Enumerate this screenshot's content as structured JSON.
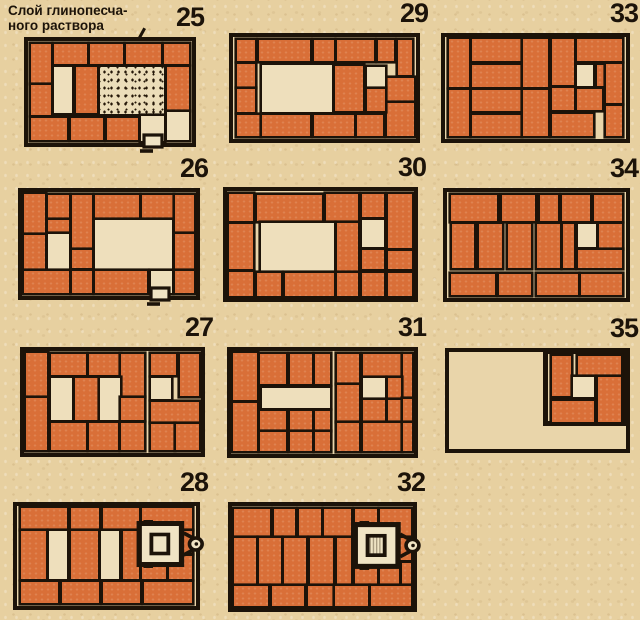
{
  "figure": {
    "annotation_line1": "Слой глинопесча-",
    "annotation_line2": "ного раствора",
    "annotation_target": "stippled mortar area of course 25"
  },
  "colors": {
    "paper": "#e7d0a0",
    "panel_paper": "#e9d5aa",
    "brick": "#d96f38",
    "void": "#eedfbc",
    "line": "#1c1309",
    "cream": "#f0e4c4"
  },
  "legend": {
    "b": "brick (plan view)",
    "v": "empty flue / void",
    "m": "clay-sand mortar layer (stippled)",
    "f": "heavy frame around flue cluster"
  },
  "panels": [
    {
      "num": "25",
      "box": [
        24,
        37,
        172,
        110
      ],
      "rects": [
        [
          2,
          3,
          12,
          38,
          "b"
        ],
        [
          16,
          3,
          20,
          20,
          "b"
        ],
        [
          38,
          3,
          20,
          20,
          "b"
        ],
        [
          60,
          3,
          21,
          20,
          "b"
        ],
        [
          83,
          3,
          15,
          20,
          "b"
        ],
        [
          85,
          25,
          13,
          43,
          "b"
        ],
        [
          2,
          43,
          12,
          30,
          "b"
        ],
        [
          2,
          75,
          22,
          22,
          "b"
        ],
        [
          26,
          75,
          20,
          22,
          "b"
        ],
        [
          48,
          75,
          19,
          22,
          "b"
        ],
        [
          16,
          25,
          11,
          46,
          "v"
        ],
        [
          29,
          25,
          13,
          46,
          "b"
        ],
        [
          44,
          25,
          39,
          47,
          "m"
        ],
        [
          69,
          74,
          14,
          24,
          "v"
        ],
        [
          85,
          70,
          13,
          27,
          "v"
        ]
      ],
      "symbols": [
        {
          "t": "door",
          "x": 68,
          "y": 90
        }
      ]
    },
    {
      "num": "29",
      "box": [
        229,
        33,
        191,
        110
      ],
      "rects": [
        [
          2,
          3,
          10,
          21,
          "b"
        ],
        [
          2,
          26,
          10,
          23,
          "b"
        ],
        [
          2,
          51,
          10,
          23,
          "b"
        ],
        [
          2,
          76,
          13,
          21,
          "b"
        ],
        [
          14,
          3,
          28,
          21,
          "b"
        ],
        [
          44,
          3,
          11,
          21,
          "b"
        ],
        [
          57,
          3,
          20,
          21,
          "b"
        ],
        [
          79,
          3,
          9,
          21,
          "b"
        ],
        [
          90,
          3,
          8,
          34,
          "b"
        ],
        [
          84,
          40,
          15,
          23,
          "b"
        ],
        [
          84,
          65,
          15,
          32,
          "b"
        ],
        [
          73,
          29,
          10,
          20,
          "v"
        ],
        [
          73,
          51,
          10,
          22,
          "b"
        ],
        [
          56,
          28,
          15,
          45,
          "b"
        ],
        [
          16,
          27,
          38,
          47,
          "v"
        ],
        [
          16,
          76,
          26,
          21,
          "b"
        ],
        [
          44,
          76,
          22,
          21,
          "b"
        ],
        [
          68,
          76,
          14,
          21,
          "b"
        ]
      ],
      "symbols": []
    },
    {
      "num": "33",
      "box": [
        441,
        33,
        189,
        110
      ],
      "rects": [
        [
          2,
          2,
          11,
          47,
          "b"
        ],
        [
          2,
          52,
          11,
          45,
          "b"
        ],
        [
          15,
          2,
          27,
          22,
          "b"
        ],
        [
          15,
          27,
          27,
          22,
          "b"
        ],
        [
          15,
          52,
          27,
          21,
          "b"
        ],
        [
          15,
          76,
          27,
          21,
          "b"
        ],
        [
          43,
          2,
          14,
          47,
          "b"
        ],
        [
          43,
          52,
          14,
          45,
          "b"
        ],
        [
          59,
          2,
          12,
          45,
          "b"
        ],
        [
          59,
          50,
          12,
          22,
          "b"
        ],
        [
          59,
          75,
          23,
          22,
          "b"
        ],
        [
          73,
          2,
          25,
          22,
          "b"
        ],
        [
          73,
          27,
          9,
          21,
          "v"
        ],
        [
          84,
          27,
          4,
          21,
          "b"
        ],
        [
          89,
          26,
          9,
          39,
          "b"
        ],
        [
          73,
          51,
          14,
          21,
          "b"
        ],
        [
          89,
          68,
          9,
          29,
          "b"
        ]
      ],
      "symbols": []
    },
    {
      "num": "26",
      "box": [
        18,
        188,
        182,
        112
      ],
      "rects": [
        [
          1,
          2,
          12,
          37,
          "b"
        ],
        [
          15,
          3,
          12,
          22,
          "b"
        ],
        [
          29,
          3,
          11,
          51,
          "b"
        ],
        [
          42,
          3,
          25,
          22,
          "b"
        ],
        [
          69,
          3,
          18,
          22,
          "b"
        ],
        [
          88,
          3,
          11,
          35,
          "b"
        ],
        [
          15,
          27,
          12,
          11,
          "b"
        ],
        [
          1,
          41,
          12,
          33,
          "b"
        ],
        [
          15,
          40,
          12,
          34,
          "v"
        ],
        [
          29,
          56,
          11,
          17,
          "b"
        ],
        [
          42,
          27,
          44,
          47,
          "v"
        ],
        [
          88,
          40,
          11,
          34,
          "b"
        ],
        [
          1,
          76,
          26,
          21,
          "b"
        ],
        [
          29,
          76,
          11,
          21,
          "b"
        ],
        [
          42,
          76,
          30,
          21,
          "b"
        ],
        [
          74,
          76,
          12,
          21,
          "v"
        ],
        [
          88,
          76,
          11,
          21,
          "b"
        ]
      ],
      "symbols": [
        {
          "t": "door",
          "x": 72,
          "y": 90
        }
      ]
    },
    {
      "num": "30",
      "box": [
        223,
        187,
        195,
        115
      ],
      "rects": [
        [
          1,
          3,
          13,
          25,
          "b"
        ],
        [
          16,
          4,
          35,
          24,
          "b"
        ],
        [
          53,
          3,
          17,
          25,
          "b"
        ],
        [
          72,
          3,
          12,
          21,
          "b"
        ],
        [
          86,
          3,
          13,
          50,
          "b"
        ],
        [
          1,
          31,
          13,
          42,
          "b"
        ],
        [
          18,
          30,
          39,
          46,
          "v"
        ],
        [
          59,
          30,
          11,
          46,
          "b"
        ],
        [
          72,
          27,
          12,
          25,
          "v"
        ],
        [
          72,
          55,
          12,
          18,
          "b"
        ],
        [
          86,
          56,
          13,
          17,
          "b"
        ],
        [
          1,
          76,
          13,
          22,
          "b"
        ],
        [
          16,
          77,
          13,
          21,
          "b"
        ],
        [
          31,
          77,
          26,
          21,
          "b"
        ],
        [
          59,
          77,
          11,
          21,
          "b"
        ],
        [
          72,
          77,
          12,
          21,
          "b"
        ],
        [
          86,
          77,
          13,
          21,
          "b"
        ]
      ],
      "symbols": []
    },
    {
      "num": "34",
      "box": [
        443,
        188,
        187,
        114
      ],
      "rects": [
        [
          2,
          3,
          26,
          24,
          "b"
        ],
        [
          31,
          3,
          18,
          24,
          "b"
        ],
        [
          52,
          3,
          10,
          24,
          "b"
        ],
        [
          64,
          3,
          16,
          24,
          "b"
        ],
        [
          82,
          3,
          16,
          24,
          "b"
        ],
        [
          3,
          30,
          12,
          42,
          "b"
        ],
        [
          18,
          30,
          13,
          42,
          "b"
        ],
        [
          34,
          30,
          13,
          42,
          "b"
        ],
        [
          50,
          30,
          13,
          42,
          "b"
        ],
        [
          65,
          30,
          6,
          42,
          "b"
        ],
        [
          73,
          30,
          10,
          22,
          "v"
        ],
        [
          85,
          30,
          13,
          23,
          "b"
        ],
        [
          73,
          55,
          25,
          17,
          "b"
        ],
        [
          2,
          77,
          25,
          20,
          "b"
        ],
        [
          29,
          77,
          18,
          20,
          "b"
        ],
        [
          50,
          77,
          23,
          20,
          "b"
        ],
        [
          75,
          77,
          23,
          20,
          "b"
        ]
      ],
      "symbols": []
    },
    {
      "num": "27",
      "box": [
        20,
        347,
        185,
        110
      ],
      "rects": [
        [
          1,
          2,
          12,
          42,
          "b"
        ],
        [
          1,
          46,
          12,
          51,
          "b"
        ],
        [
          15,
          3,
          20,
          21,
          "b"
        ],
        [
          37,
          3,
          17,
          21,
          "b"
        ],
        [
          55,
          3,
          13,
          41,
          "b"
        ],
        [
          15,
          26,
          12,
          42,
          "v"
        ],
        [
          29,
          26,
          13,
          42,
          "b"
        ],
        [
          43,
          26,
          11,
          42,
          "v"
        ],
        [
          55,
          46,
          13,
          22,
          "b"
        ],
        [
          15,
          71,
          20,
          26,
          "b"
        ],
        [
          37,
          71,
          16,
          26,
          "b"
        ],
        [
          55,
          71,
          13,
          26,
          "b"
        ],
        [
          72,
          3,
          14,
          21,
          "b"
        ],
        [
          88,
          3,
          11,
          41,
          "b"
        ],
        [
          72,
          26,
          11,
          21,
          "v"
        ],
        [
          72,
          50,
          27,
          20,
          "b"
        ],
        [
          72,
          72,
          13,
          25,
          "b"
        ],
        [
          86,
          72,
          13,
          25,
          "b"
        ]
      ],
      "symbols": []
    },
    {
      "num": "31",
      "box": [
        227,
        347,
        191,
        111
      ],
      "rects": [
        [
          1,
          2,
          13,
          46,
          "b"
        ],
        [
          1,
          50,
          13,
          47,
          "b"
        ],
        [
          16,
          3,
          14,
          29,
          "b"
        ],
        [
          32,
          3,
          12,
          29,
          "b"
        ],
        [
          46,
          3,
          8,
          29,
          "b"
        ],
        [
          17,
          36,
          37,
          19,
          "v"
        ],
        [
          16,
          58,
          14,
          19,
          "b"
        ],
        [
          32,
          58,
          12,
          19,
          "b"
        ],
        [
          46,
          58,
          8,
          19,
          "b"
        ],
        [
          16,
          79,
          14,
          18,
          "b"
        ],
        [
          32,
          79,
          12,
          18,
          "b"
        ],
        [
          46,
          79,
          8,
          18,
          "b"
        ],
        [
          58,
          3,
          12,
          28,
          "b"
        ],
        [
          72,
          3,
          21,
          21,
          "b"
        ],
        [
          94,
          3,
          5,
          42,
          "b"
        ],
        [
          58,
          33,
          12,
          35,
          "b"
        ],
        [
          72,
          26,
          12,
          20,
          "v"
        ],
        [
          86,
          26,
          7,
          20,
          "b"
        ],
        [
          72,
          48,
          12,
          20,
          "b"
        ],
        [
          86,
          48,
          7,
          20,
          "b"
        ],
        [
          58,
          70,
          12,
          27,
          "b"
        ],
        [
          72,
          70,
          21,
          27,
          "b"
        ],
        [
          94,
          47,
          5,
          21,
          "b"
        ],
        [
          94,
          70,
          5,
          27,
          "b"
        ]
      ],
      "symbols": []
    },
    {
      "num": "35",
      "box": [
        445,
        348,
        185,
        105
      ],
      "rects": [
        [
          53,
          -3,
          47,
          79,
          "f"
        ],
        [
          58,
          4,
          11,
          41,
          "b"
        ],
        [
          73,
          4,
          24,
          20,
          "b"
        ],
        [
          70,
          26,
          12,
          20,
          "v"
        ],
        [
          84,
          26,
          13,
          46,
          "b"
        ],
        [
          58,
          50,
          24,
          22,
          "b"
        ]
      ],
      "symbols": []
    },
    {
      "num": "28",
      "box": [
        13,
        502,
        187,
        108
      ],
      "rects": [
        [
          2,
          2,
          26,
          21,
          "b"
        ],
        [
          30,
          2,
          16,
          21,
          "b"
        ],
        [
          48,
          2,
          20,
          21,
          "b"
        ],
        [
          70,
          2,
          28,
          21,
          "b"
        ],
        [
          2,
          25,
          14,
          48,
          "b"
        ],
        [
          18,
          25,
          10,
          48,
          "v"
        ],
        [
          30,
          25,
          15,
          48,
          "b"
        ],
        [
          47,
          25,
          10,
          48,
          "v"
        ],
        [
          59,
          25,
          9,
          48,
          "b"
        ],
        [
          70,
          25,
          13,
          22,
          "b"
        ],
        [
          85,
          25,
          13,
          22,
          "b"
        ],
        [
          70,
          50,
          13,
          23,
          "b"
        ],
        [
          85,
          50,
          13,
          23,
          "b"
        ],
        [
          2,
          76,
          21,
          21,
          "b"
        ],
        [
          25,
          76,
          21,
          21,
          "b"
        ],
        [
          48,
          76,
          21,
          21,
          "b"
        ],
        [
          71,
          76,
          27,
          21,
          "b"
        ]
      ],
      "symbols": [
        {
          "t": "damper",
          "x": 66,
          "y": 14,
          "hatch": false
        }
      ]
    },
    {
      "num": "32",
      "box": [
        228,
        502,
        189,
        110
      ],
      "rects": [
        [
          1,
          3,
          20,
          26,
          "b"
        ],
        [
          23,
          3,
          12,
          26,
          "b"
        ],
        [
          37,
          3,
          12,
          26,
          "b"
        ],
        [
          51,
          3,
          15,
          26,
          "b"
        ],
        [
          68,
          3,
          12,
          26,
          "b"
        ],
        [
          82,
          3,
          17,
          26,
          "b"
        ],
        [
          1,
          31,
          12,
          45,
          "b"
        ],
        [
          15,
          31,
          12,
          45,
          "b"
        ],
        [
          29,
          31,
          12,
          45,
          "b"
        ],
        [
          43,
          31,
          13,
          45,
          "b"
        ],
        [
          58,
          31,
          8,
          45,
          "b"
        ],
        [
          68,
          31,
          12,
          22,
          "b"
        ],
        [
          82,
          31,
          17,
          22,
          "b"
        ],
        [
          94,
          56,
          5,
          20,
          "b"
        ],
        [
          68,
          56,
          12,
          20,
          "b"
        ],
        [
          82,
          56,
          10,
          20,
          "b"
        ],
        [
          1,
          78,
          19,
          20,
          "b"
        ],
        [
          22,
          78,
          18,
          20,
          "b"
        ],
        [
          42,
          78,
          14,
          20,
          "b"
        ],
        [
          57,
          78,
          18,
          20,
          "b"
        ],
        [
          77,
          78,
          22,
          20,
          "b"
        ]
      ],
      "symbols": [
        {
          "t": "damper",
          "x": 66,
          "y": 15,
          "hatch": true
        }
      ]
    }
  ]
}
